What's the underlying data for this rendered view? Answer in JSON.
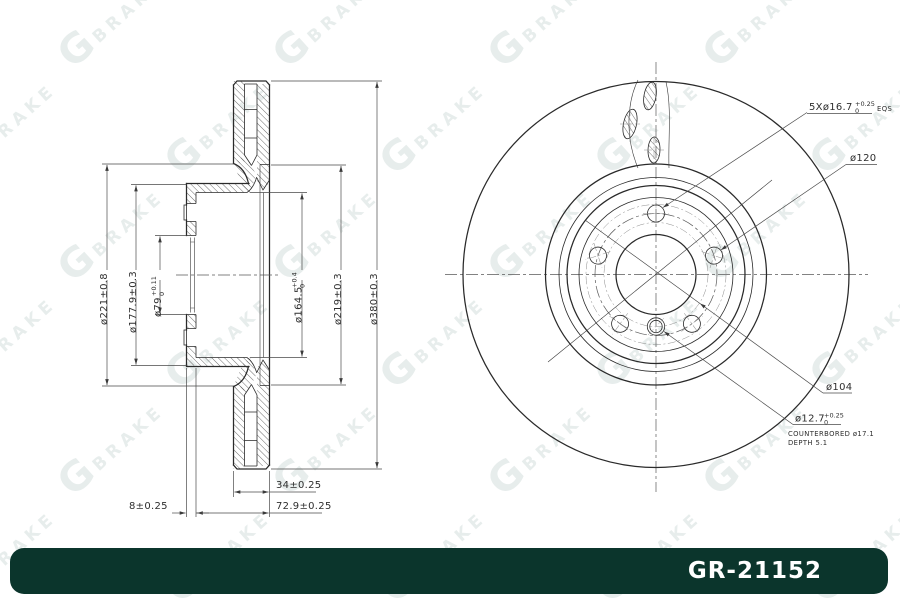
{
  "part_number": "GR-21152",
  "watermark": {
    "g": "G",
    "brake": "BRAKE"
  },
  "colors": {
    "footer_bg": "#0b352c",
    "watermark": "#e7edec",
    "line": "#2a2a2a"
  },
  "section_view": {
    "dims": {
      "d221": "ø221±0.8",
      "d177": "ø177.9±0.3",
      "d79_base": "ø79",
      "d79_tol_top": "+0.11",
      "d79_tol_bot": "0",
      "d164_base": "ø164.5",
      "d164_tol_top": "+0.4",
      "d164_tol_bot": "0",
      "d219": "ø219±0.3",
      "d380": "ø380±0.3",
      "w34": "34±0.25",
      "w8": "8±0.25",
      "w729": "72.9±0.25"
    }
  },
  "front_view": {
    "labels": {
      "bolt_holes_base": "5Xø16.7",
      "bolt_holes_tol_top": "+0.25",
      "bolt_holes_tol_bot": "0",
      "bolt_holes_suffix": "EQS",
      "d120": "ø120",
      "d104": "ø104",
      "d127_base": "ø12.7",
      "d127_tol_top": "+0.25",
      "d127_tol_bot": "0",
      "counterbore_line1": "COUNTERBORED  ø17.1",
      "counterbore_line2": "DEPTH  5.1"
    }
  }
}
